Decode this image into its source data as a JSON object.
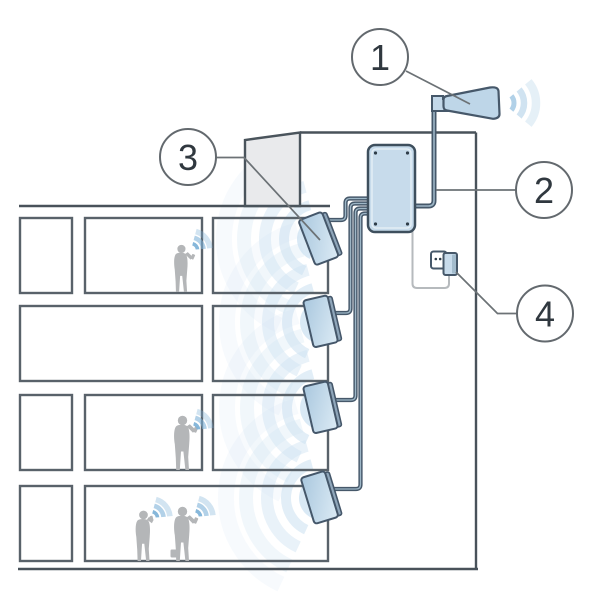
{
  "diagram": {
    "name": "cellular-signal-booster-building-diagram",
    "callouts": [
      {
        "number": "1",
        "component": "outdoor-donor-antenna-icon"
      },
      {
        "number": "2",
        "component": "signal-booster-unit-icon"
      },
      {
        "number": "3",
        "component": "indoor-panel-antenna-icon"
      },
      {
        "number": "4",
        "component": "power-outlet-plug-icon"
      }
    ],
    "colors": {
      "outline": "#49525a",
      "device_fill": "#c7dbeb",
      "panel_fill_light": "#d9e9f4",
      "panel_fill_dark": "#a9c7de",
      "wave_strong": "#7fb3d8",
      "wave_soft": "#cfe3f2",
      "roof_fill": "#e9eaec",
      "silhouette": "#b4b6b8",
      "callout_text": "#30383f",
      "background": "#ffffff"
    }
  }
}
